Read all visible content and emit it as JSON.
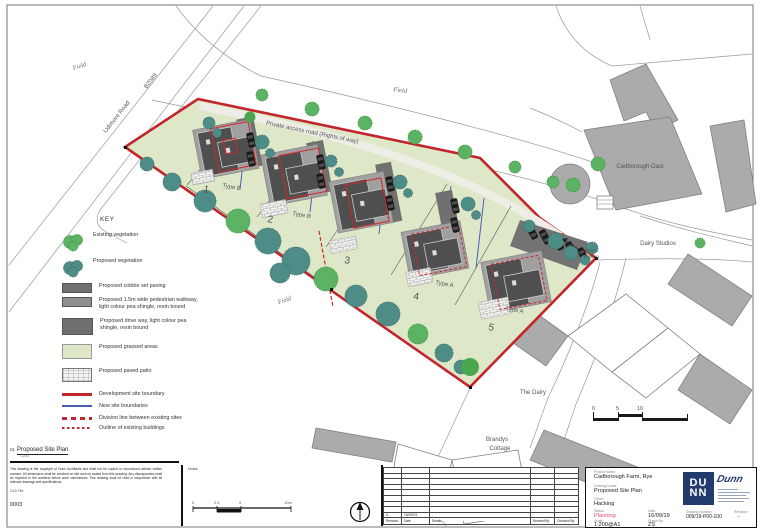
{
  "map": {
    "labels": {
      "field_nw": "Field",
      "field_n": "Field",
      "field_s": "Field",
      "udimore_road": "Udimore Road",
      "road_number": "B2089",
      "private_access_road": "Private access road  (Rights of way)",
      "cadborough_oast": "Cadborough Oast",
      "dairy_studios": "Dairy Studios",
      "the_dairy": "The Dairy",
      "brandys_1": "Brandys",
      "brandys_2": "Cottage",
      "visitors_1": "Visitor's",
      "visitors_2": "parking"
    },
    "plots": [
      "1",
      "2",
      "3",
      "4",
      "5"
    ],
    "type_labels": [
      "Type B",
      "Type B",
      "Type A",
      "Type A"
    ],
    "scalebar": [
      "0",
      "5",
      "10"
    ]
  },
  "key": {
    "title": "KEY",
    "items": [
      "Existing vegetation",
      "Proposed vegetation",
      "Proposed cobble set paving",
      "Proposed 1.5m wide pedestrian walkway, light colour pea shingle, resin bound",
      "Proposed drive way, light colour pea shingle, resin bound",
      "Proposed grassed areas",
      "Proposed paved patio",
      "Development site boundary",
      "New site boundaries",
      "Division line between existing sites",
      "Outline of existing buildings"
    ]
  },
  "drawing_label": {
    "number": "01",
    "title": "Proposed Site Plan",
    "scale": "1:200"
  },
  "disclaimer": "This drawing is the copyright of Dunn Architects and shall not be copied or reproduced without written consent. All dimensions shall be checked on site and not scaled from this drawing. Any discrepancies shall be reported to the architect before work commences. This drawing shall be read in conjunction with all relevant drawings and specifications.",
  "cad_file": {
    "label": "CAD File:",
    "value": "0003"
  },
  "notes": {
    "label": "Notes:",
    "scalebar": [
      "0",
      "2.5",
      "5",
      "10m"
    ]
  },
  "revision_table": {
    "headers": [
      "Revision",
      "Date",
      "Details",
      "Revised By",
      "Checked By"
    ],
    "row": [
      "A",
      "16/09/19",
      "-",
      "-",
      "-"
    ]
  },
  "title_block": {
    "project_name_label": "Project Name:",
    "project_name": "Cadborough Farm, Rye",
    "drawing_name_label": "Drawing Name:",
    "drawing_name": "Proposed Site Plan",
    "client_label": "Client:",
    "client": "Hacking",
    "status_label": "Status:",
    "status": "Planning",
    "date_label": "Date:",
    "date": "16/09/19",
    "scale_label": "Scale:",
    "scale": "1:200@A1",
    "drawn_by_label": "Drawn By:",
    "drawn_by": "ZS",
    "drawing_number_label": "Drawing Number:",
    "drawing_number": "009/19-P00-100",
    "revision_label": "Revision:",
    "revision": "-",
    "logo_line1": "DU",
    "logo_line2": "NN",
    "logo_signature": "Dunn"
  },
  "colors": {
    "development_boundary_red": "#c2252b",
    "new_site_boundary_blue": "#4a5db5",
    "status_red": "#e0506a",
    "logo_navy": "#233a6d",
    "grass_green": "#dee8c9",
    "existing_vegetation_green": "#5cb363",
    "proposed_vegetation_teal": "#4e8c87"
  }
}
